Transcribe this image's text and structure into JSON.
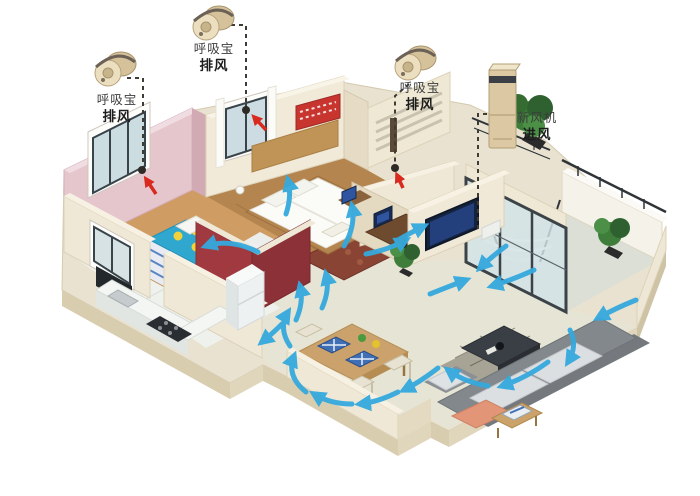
{
  "scene": {
    "description": "3D isometric apartment cutaway showing fresh-air ventilation airflow",
    "background": "#ffffff"
  },
  "devices": [
    {
      "id": "exhaust-unit-1",
      "kind": "ceiling-exhaust-fan",
      "label_line1": "呼吸宝",
      "label_line2": "排风"
    },
    {
      "id": "exhaust-unit-2",
      "kind": "ceiling-exhaust-fan",
      "label_line1": "呼吸宝",
      "label_line2": "排风"
    },
    {
      "id": "exhaust-unit-3",
      "kind": "ceiling-exhaust-fan",
      "label_line1": "呼吸宝",
      "label_line2": "排风"
    },
    {
      "id": "fresh-air-unit",
      "kind": "fresh-air-tower",
      "label_line1": "新风机",
      "label_line2": "进风"
    }
  ],
  "colors": {
    "airflow_arrow": "#35a9dd",
    "exhaust_arrow": "#d82a1e",
    "wall_cream": "#f0e9d7",
    "wall_pink": "#e6c6cd",
    "wall_red": "#a03a40",
    "floor_wood": "#b5854f",
    "floor_tile": "#eff1ec",
    "sofa_grey": "#83888d",
    "device_body": "#ecdfc0",
    "leader_line": "#3f3b35"
  }
}
